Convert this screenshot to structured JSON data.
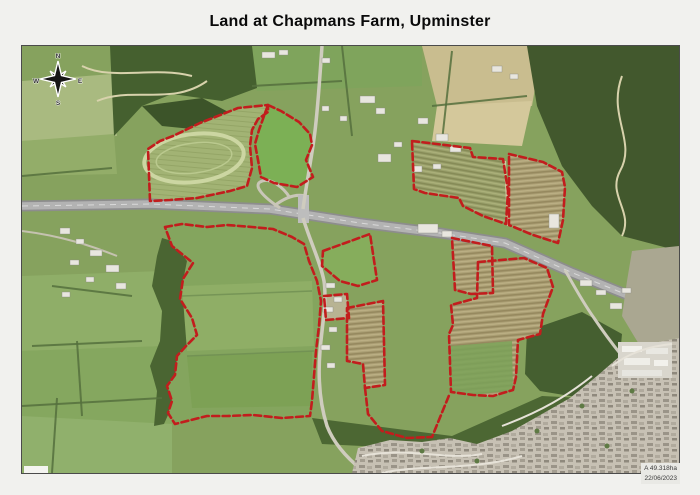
{
  "page": {
    "title": "Land at Chapmans Farm, Upminster"
  },
  "map": {
    "boundary_color": "#c21d1d",
    "compass": {
      "n": "N",
      "e": "E",
      "s": "S",
      "w": "W"
    },
    "annotation": {
      "line1": "A 49.318ha",
      "line2": "22/06/2023"
    },
    "parcels": [
      {
        "id": "nw-oval-field",
        "closed": true,
        "points": "128,155 126,103 138,95 151,90 178,77 216,62 246,59 246,66 236,73 230,84 228,100 230,122 225,140 208,145 175,152 148,154"
      },
      {
        "id": "green-paddock",
        "closed": true,
        "points": "246,59 259,65 277,76 288,88 290,99 284,114 291,131 275,141 252,137 239,131 236,114 233,98 237,84 242,70"
      },
      {
        "id": "ne-field-west",
        "closed": true,
        "points": "390,95 448,102 451,111 481,113 486,145 484,178 461,170 441,160 437,152 403,147 392,143"
      },
      {
        "id": "ne-field-east",
        "closed": true,
        "points": "487,108 521,116 540,126 543,141 541,174 536,197 511,189 487,179"
      },
      {
        "id": "junction-field",
        "closed": true,
        "points": "301,205 348,188 355,234 336,240 318,235 300,220"
      },
      {
        "id": "central-field",
        "closed": true,
        "points": "430,192 470,200 471,247 449,248 433,244"
      },
      {
        "id": "se-field",
        "closed": true,
        "points": "456,216 502,212 525,222 531,241 521,268 518,288 496,294 494,331 491,344 471,350 451,349 429,346 427,288 431,279 429,259 455,252"
      },
      {
        "id": "roadside-field",
        "closed": true,
        "points": "325,262 361,255 363,339 343,342 341,318 325,315"
      },
      {
        "id": "farmstead-plot",
        "closed": true,
        "points": "302,250 325,248 327,272 304,274"
      },
      {
        "id": "sw-field",
        "closed": true,
        "points": "143,181 160,178 185,181 205,179 230,181 251,183 270,191 282,198 287,215 295,235 299,255 297,280 294,305 292,330 290,355 288,370 260,372 231,369 205,370 185,370 153,378 146,367 150,355 145,340 153,329 155,310 165,299 175,289 170,272 158,253 161,233 171,217 150,200"
      },
      {
        "id": "south-link",
        "closed": false,
        "points": "343,342 346,368 360,385 385,392 410,391 428,347"
      }
    ]
  }
}
